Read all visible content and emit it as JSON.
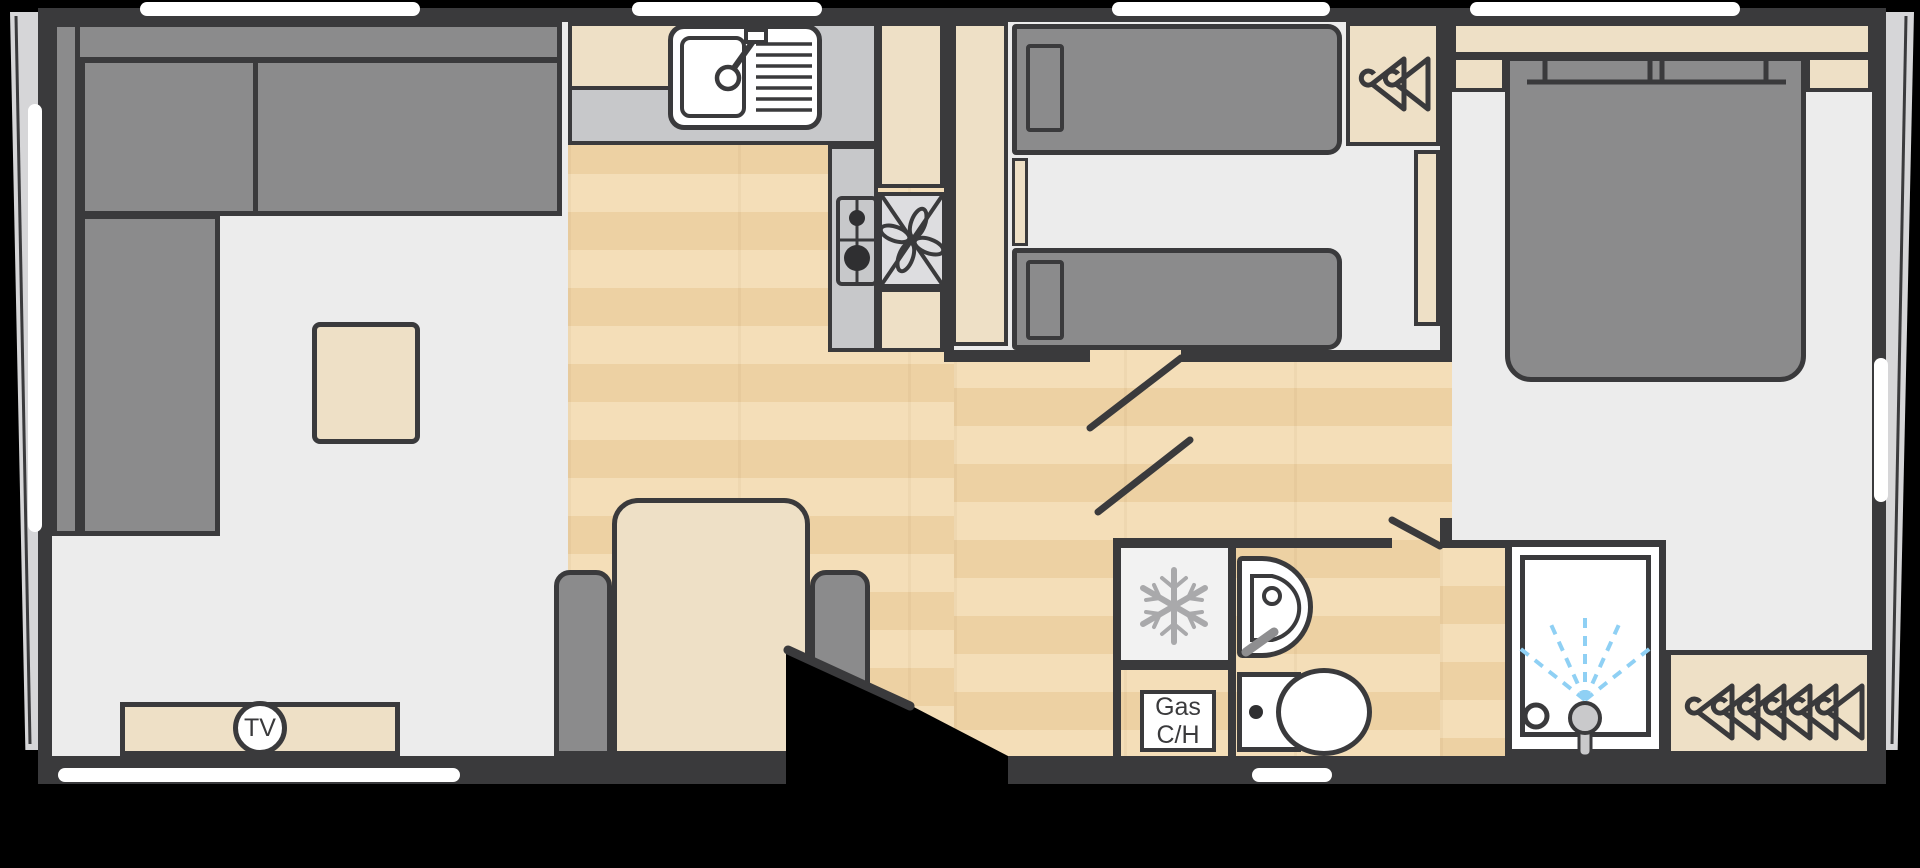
{
  "plan": {
    "type": "caravan-floorplan",
    "rooms": [
      "lounge",
      "kitchen",
      "dining-area",
      "twin-bedroom",
      "bathroom",
      "master-bedroom"
    ]
  },
  "labels": {
    "tv": "TV",
    "gas_line1": "Gas",
    "gas_line2": "C/H"
  },
  "icons": {
    "tv_badge": "circled TV label on media unit",
    "snowflake_icon": "fridge freezer",
    "extractor_fan_icon": "cooker hood fan",
    "burner_icon": "two-ring gas hob",
    "tap_icon": "kitchen sink mixer tap",
    "drainer_icon": "sink drainer grooves",
    "coat_hanger_icon": "wardrobe hanging rail",
    "basin_icon": "bathroom wash basin",
    "toilet_icon": "WC cistern and pan",
    "shower_spray_icon": "shower head with spray",
    "door_leaf_icon": "open door swing line",
    "window": "white window strip in wall"
  },
  "palette": {
    "background": "#000000",
    "walls": "#3a3a3c",
    "upholstery_gray": "#8b8b8c",
    "cabinet_beige": "#eee0c6",
    "floor_light": "#ececec",
    "wood_floor": "#f0d6aa",
    "worktop_gray": "#c7c8ca",
    "window_white": "#ffffff",
    "shower_spray_blue": "#8fd0f4"
  }
}
